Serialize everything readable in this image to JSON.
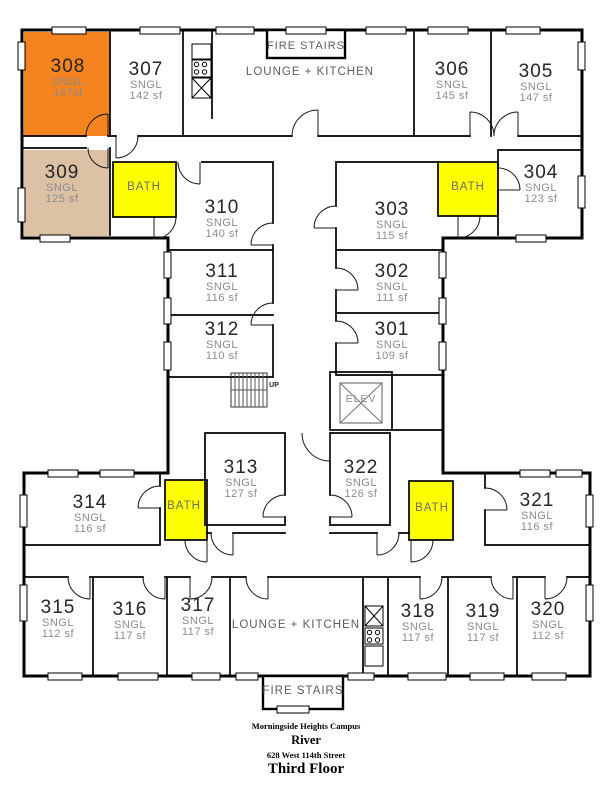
{
  "plan": {
    "labels": {
      "fire_stairs_top": "FIRE STAIRS",
      "fire_stairs_bottom": "FIRE STAIRS",
      "lounge_top": "LOUNGE + KITCHEN",
      "lounge_bottom": "LOUNGE + KITCHEN",
      "elevator": "ELEV",
      "stairs_up": "UP"
    },
    "bath_label": "BATH",
    "rooms": [
      {
        "number": "301",
        "type": "SNGL",
        "area": "109 sf",
        "fill": "none"
      },
      {
        "number": "302",
        "type": "SNGL",
        "area": "111 sf",
        "fill": "none"
      },
      {
        "number": "303",
        "type": "SNGL",
        "area": "115 sf",
        "fill": "none"
      },
      {
        "number": "304",
        "type": "SNGL",
        "area": "123 sf",
        "fill": "none"
      },
      {
        "number": "305",
        "type": "SNGL",
        "area": "147 sf",
        "fill": "none"
      },
      {
        "number": "306",
        "type": "SNGL",
        "area": "145 sf",
        "fill": "none"
      },
      {
        "number": "307",
        "type": "SNGL",
        "area": "142 sf",
        "fill": "none"
      },
      {
        "number": "308",
        "type": "SNGL",
        "area": "147sf",
        "fill": "orange"
      },
      {
        "number": "309",
        "type": "SNGL",
        "area": "125 sf",
        "fill": "tan"
      },
      {
        "number": "310",
        "type": "SNGL",
        "area": "140 sf",
        "fill": "none"
      },
      {
        "number": "311",
        "type": "SNGL",
        "area": "116 sf",
        "fill": "none"
      },
      {
        "number": "312",
        "type": "SNGL",
        "area": "110 sf",
        "fill": "none"
      },
      {
        "number": "313",
        "type": "SNGL",
        "area": "127 sf",
        "fill": "none"
      },
      {
        "number": "314",
        "type": "SNGL",
        "area": "116 sf",
        "fill": "none"
      },
      {
        "number": "315",
        "type": "SNGL",
        "area": "112 sf",
        "fill": "none"
      },
      {
        "number": "316",
        "type": "SNGL",
        "area": "117 sf",
        "fill": "none"
      },
      {
        "number": "317",
        "type": "SNGL",
        "area": "117 sf",
        "fill": "none"
      },
      {
        "number": "318",
        "type": "SNGL",
        "area": "117 sf",
        "fill": "none"
      },
      {
        "number": "319",
        "type": "SNGL",
        "area": "117 sf",
        "fill": "none"
      },
      {
        "number": "320",
        "type": "SNGL",
        "area": "112 sf",
        "fill": "none"
      },
      {
        "number": "321",
        "type": "SNGL",
        "area": "116 sf",
        "fill": "none"
      },
      {
        "number": "322",
        "type": "SNGL",
        "area": "126 sf",
        "fill": "none"
      }
    ],
    "colors": {
      "room_308": "#F5831F",
      "room_309": "#DCC1A5",
      "bath": "#FFFF00",
      "wall": "#000000",
      "number_text": "#262626",
      "detail_text": "#8c8c8c",
      "label_text": "#5c5c5c"
    }
  },
  "footer": {
    "campus": "Morningside Heights Campus",
    "building": "River",
    "address": "628 West 114th Street",
    "floor": "Third Floor"
  }
}
